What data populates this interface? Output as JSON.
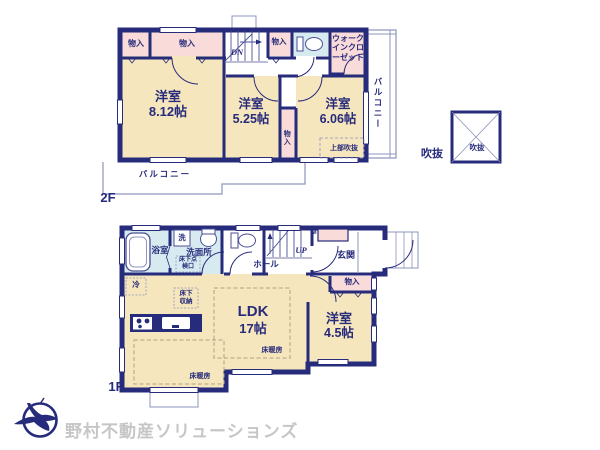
{
  "floors": {
    "f2": {
      "label": "2F"
    },
    "f1": {
      "label": "1F"
    }
  },
  "labels": {
    "storage": "物入",
    "walk_in_closet": "ウォークインクローゼット",
    "balcony": "バルコニー",
    "stairs_down": "DN",
    "stairs_up": "UP",
    "void_legend": "吹抜",
    "upper_void": "上部吹抜",
    "bath": "浴室",
    "laundry": "洗",
    "washroom": "洗面所",
    "underfloor_hatch": "床下点検口",
    "hall": "ホール",
    "meter": "M",
    "entrance": "玄関",
    "fridge": "冷",
    "underfloor_storage": "床下収納",
    "floor_heating": "床暖房"
  },
  "rooms": {
    "western_812": {
      "name": "洋室",
      "size": "8.12帖"
    },
    "western_525": {
      "name": "洋室",
      "size": "5.25帖"
    },
    "western_606": {
      "name": "洋室",
      "size": "6.06帖"
    },
    "western_45": {
      "name": "洋室",
      "size": "4.5帖"
    },
    "ldk": {
      "name": "LDK",
      "size": "17帖"
    }
  },
  "footer": {
    "company": "野村不動産ソリューションズ"
  },
  "colors": {
    "wall": "#272b7b",
    "room_cream": "#f6e6bd",
    "closet_pink": "#f9dbd9",
    "wet_blue": "#d6eaf0",
    "thin_line": "#8e94bb",
    "logo_text": "#c6c6c6"
  }
}
